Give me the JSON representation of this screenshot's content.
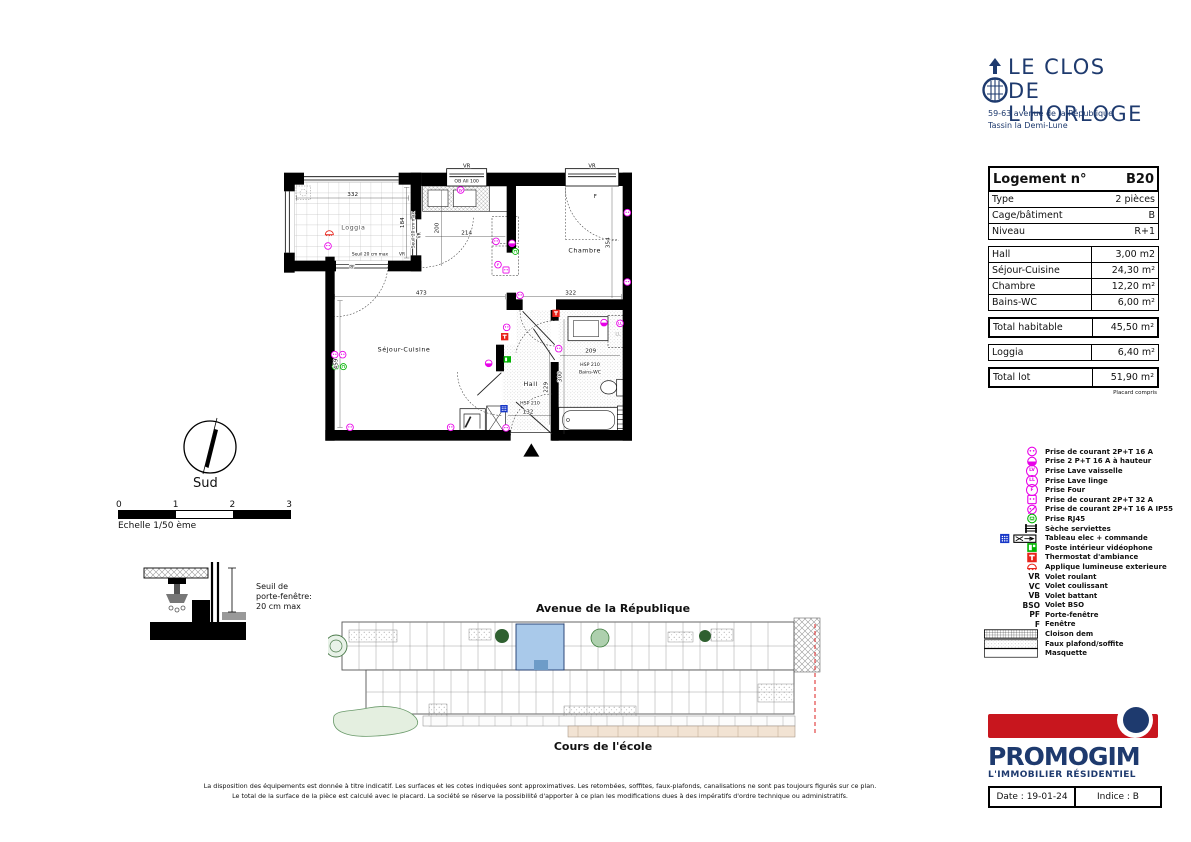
{
  "header_logo": {
    "title_line1": "LE CLOS",
    "title_line2": "DE L'HORLOGE",
    "address_line1": "59-63 avenue de la République",
    "address_line2": "Tassin la Demi-Lune"
  },
  "info_table": {
    "header": {
      "label": "Logement n°",
      "value": "B20"
    },
    "unit_rows": [
      {
        "label": "Type",
        "value": "2 pièces"
      },
      {
        "label": "Cage/bâtiment",
        "value": "B"
      },
      {
        "label": "Niveau",
        "value": "R+1"
      }
    ],
    "area_rows": [
      {
        "label": "Hall",
        "value": "3,00 m2"
      },
      {
        "label": "Séjour-Cuisine",
        "value": "24,30 m²"
      },
      {
        "label": "Chambre",
        "value": "12,20 m²"
      },
      {
        "label": "Bains-WC",
        "value": "6,00 m²"
      }
    ],
    "total_hab": {
      "label": "Total habitable",
      "value": "45,50 m²"
    },
    "loggia_row": {
      "label": "Loggia",
      "value": "6,40 m²"
    },
    "total_lot": {
      "label": "Total lot",
      "value": "51,90 m²"
    },
    "footnote": "Placard compris"
  },
  "legend": {
    "items": [
      {
        "icon": "ic-outlet",
        "icon_text": "",
        "code": "",
        "label": "Prise de courant 2P+T 16 A"
      },
      {
        "icon": "ic-outlet-h",
        "icon_text": "",
        "code": "",
        "label": "Prise 2 P+T 16 A à hauteur"
      },
      {
        "icon": "",
        "icon_text": "LV",
        "code": "",
        "label": "Prise Lave vaisselle"
      },
      {
        "icon": "",
        "icon_text": "LL",
        "code": "",
        "label": "Prise Lave linge"
      },
      {
        "icon": "",
        "icon_text": "F",
        "code": "",
        "label": "Prise Four"
      },
      {
        "icon": "ic-32",
        "icon_text": "",
        "code": "",
        "label": "Prise de courant 2P+T 32 A"
      },
      {
        "icon": "ic-ip55",
        "icon_text": "",
        "code": "",
        "label": "Prise de courant 2P+T 16 A IP55"
      },
      {
        "icon": "ic-rj45",
        "icon_text": "",
        "code": "",
        "label": "Prise RJ45"
      },
      {
        "icon": "ic-seche",
        "icon_text": "",
        "code": "",
        "label": "Sèche serviettes"
      },
      {
        "icon": "ic-tableau",
        "icon_text": "",
        "code": "",
        "label": "Tableau elec + commande"
      },
      {
        "icon": "ic-video",
        "icon_text": "",
        "code": "",
        "label": "Poste intérieur vidéophone"
      },
      {
        "icon": "ic-thermo",
        "icon_text": "",
        "code": "",
        "label": "Thermostat d'ambiance"
      },
      {
        "icon": "ic-applique",
        "icon_text": "",
        "code": "",
        "label": "Applique lumineuse exterieure"
      },
      {
        "icon": "",
        "icon_text": "",
        "code": "VR",
        "label": "Volet roulant"
      },
      {
        "icon": "",
        "icon_text": "",
        "code": "VC",
        "label": "Volet coulissant"
      },
      {
        "icon": "",
        "icon_text": "",
        "code": "VB",
        "label": "Volet battant"
      },
      {
        "icon": "",
        "icon_text": "",
        "code": "BSO",
        "label": "Volet BSO"
      },
      {
        "icon": "",
        "icon_text": "",
        "code": "PF",
        "label": "Porte-fenêtre"
      },
      {
        "icon": "",
        "icon_text": "",
        "code": "F",
        "label": "Fenêtre"
      },
      {
        "icon": "ic-cloison",
        "icon_text": "",
        "code": "",
        "label": "Cloison dem"
      },
      {
        "icon": "ic-faux",
        "icon_text": "",
        "code": "",
        "label": "Faux plafond/soffite"
      },
      {
        "icon": "ic-masquette",
        "icon_text": "",
        "code": "",
        "label": "Masquette"
      }
    ]
  },
  "plan": {
    "rooms": {
      "loggia": "Loggia",
      "sejour": "Séjour-Cuisine",
      "chambre": "Chambre",
      "hall": "Hall",
      "bains": "Bains-WC"
    },
    "dims": {
      "loggia_w": "332",
      "loggia_h": "184",
      "kitchen_w": "214",
      "kitchen_h": "200",
      "sejour_w": "473",
      "sejour_h": "459",
      "chambre_w": "322",
      "chambre_h": "354",
      "bains_w": "209",
      "bains_h": "300",
      "hall_h": "229",
      "hall_w": "132"
    },
    "notes": {
      "seuil": "Seuil 20 cm max",
      "hsp": "HSP 210",
      "window_spec": "OB All 100",
      "ll_zone": "LL"
    },
    "marks": {
      "vr": "VR",
      "pf": "PF",
      "f": "F"
    },
    "sym": {
      "lv": "LV",
      "ll": "LL",
      "four": "F"
    }
  },
  "compass": {
    "label": "Sud"
  },
  "scalebar": {
    "ticks": [
      "0",
      "1",
      "2",
      "3"
    ],
    "caption": "Echelle 1/50 ème"
  },
  "threshold_note": {
    "line1": "Seuil de",
    "line2": "porte-fenêtre:",
    "line3": "20 cm max"
  },
  "siteplan": {
    "street_top": "Avenue de la République",
    "street_bottom": "Cours de l'école"
  },
  "disclaimer": {
    "line1": "La disposition des équipements est donnée à titre indicatif. Les surfaces et les cotes indiquées sont approximatives. Les retombées, soffites, faux-plafonds, canalisations ne sont pas toujours figurés sur ce plan.",
    "line2": "Le total de la surface de la pièce est calculé avec le placard. La société se réserve la possibilité d'apporter à ce plan les modifications dues à des impératifs d'ordre technique ou administratifs."
  },
  "footer": {
    "brand": "PROMOGIM",
    "brand_sub": "L'IMMOBILIER  RÉSIDENTIEL",
    "date_label": "Date : 19-01-24",
    "indice_label": "Indice : B"
  },
  "colors": {
    "navy": "#1e3a6e",
    "brand_red": "#c8161e",
    "symbol_magenta": "#e800e8",
    "symbol_green": "#00b400",
    "symbol_red": "#e8231a",
    "tableau_blue": "#1636c8",
    "highlight_unit_blue": "#a9c9ea"
  }
}
